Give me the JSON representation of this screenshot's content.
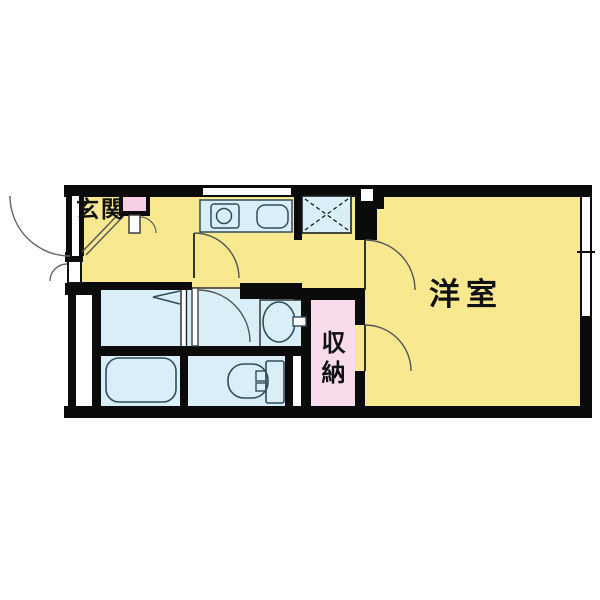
{
  "title": "apartment-floor-plan",
  "plan": {
    "rooms": [
      {
        "id": "genkan",
        "label": "玄関",
        "type": "entrance"
      },
      {
        "id": "western_room",
        "label": "洋室",
        "type": "bedroom"
      },
      {
        "id": "closet",
        "label": "収納",
        "type": "storage"
      }
    ],
    "fixtures": [
      "entrance-door",
      "entrance-door-swing",
      "meter-box-door",
      "water-heater-box",
      "genkan-step-line",
      "kitchen-counter",
      "stove-burner",
      "kitchen-sink",
      "kitchen-window",
      "washer-pan",
      "folding-door",
      "washroom-door",
      "kitchen-door",
      "washbasin",
      "faucet",
      "bathtub",
      "toilet",
      "closet-door",
      "room-door",
      "balcony-window",
      "window-tick"
    ]
  },
  "colors": {
    "bg": "#FFFFFF",
    "room-yellow": "#F8E88F",
    "wet-blue": "#DAEEF7",
    "closet-pink": "#F9DCEC",
    "utility-pink": "#F6CFE4",
    "wall-black": "#0B0B0B",
    "fixture-line": "#2F4F5A",
    "door-line": "#4A4A4A",
    "thin-line": "#222222"
  }
}
